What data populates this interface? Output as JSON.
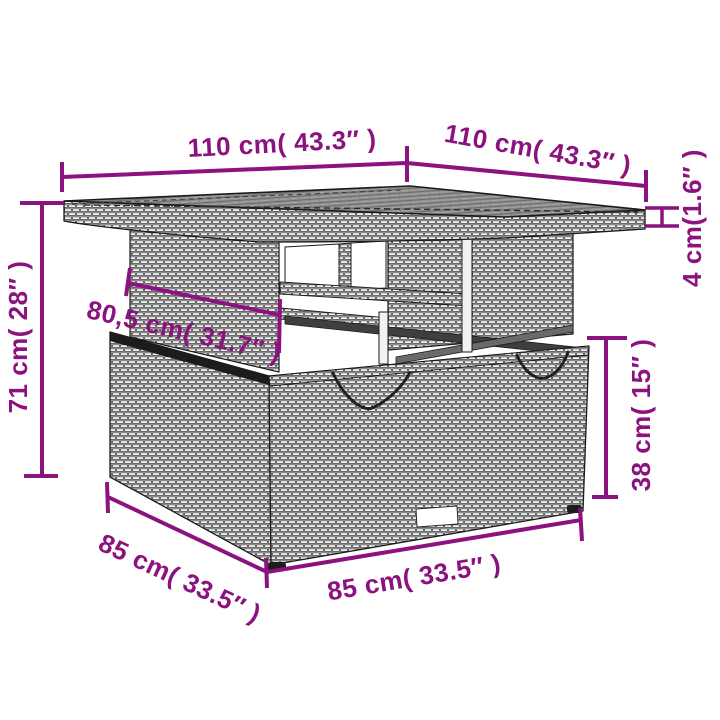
{
  "diagram": {
    "type": "product-dimension-diagram",
    "subject": "poly-rattan garden table with storage base",
    "accent_color": "#8C127F",
    "dimensions": {
      "top_width": {
        "text": "110 cm( 43.3″ )",
        "cm": 110,
        "inch": 43.3,
        "placement": "top-left, along far-left edge of tabletop"
      },
      "top_depth": {
        "text": "110 cm( 43.3″ )",
        "cm": 110,
        "inch": 43.3,
        "placement": "top-right, along far-right edge of tabletop"
      },
      "top_thickness": {
        "text": "4 cm(1.6″ )",
        "cm": 4,
        "inch": 1.6,
        "placement": "right edge, vertical, tabletop thickness"
      },
      "total_height": {
        "text": "71 cm( 28″ )",
        "cm": 71,
        "inch": 28,
        "placement": "left side, vertical, floor to tabletop"
      },
      "inner_width": {
        "text": "80,5 cm( 31.7″ )",
        "cm": 80.5,
        "inch": 31.7,
        "placement": "diagonal across riser column"
      },
      "base_height": {
        "text": "38 cm( 15″ )",
        "cm": 38,
        "inch": 15,
        "placement": "right side, vertical, base box height"
      },
      "base_depth": {
        "text": "85 cm( 33.5″ )",
        "cm": 85,
        "inch": 33.5,
        "placement": "bottom-left, along left bottom edge of base"
      },
      "base_width": {
        "text": "85 cm( 33.5″ )",
        "cm": 85,
        "inch": 33.5,
        "placement": "bottom-center, along front bottom edge of base"
      }
    }
  }
}
